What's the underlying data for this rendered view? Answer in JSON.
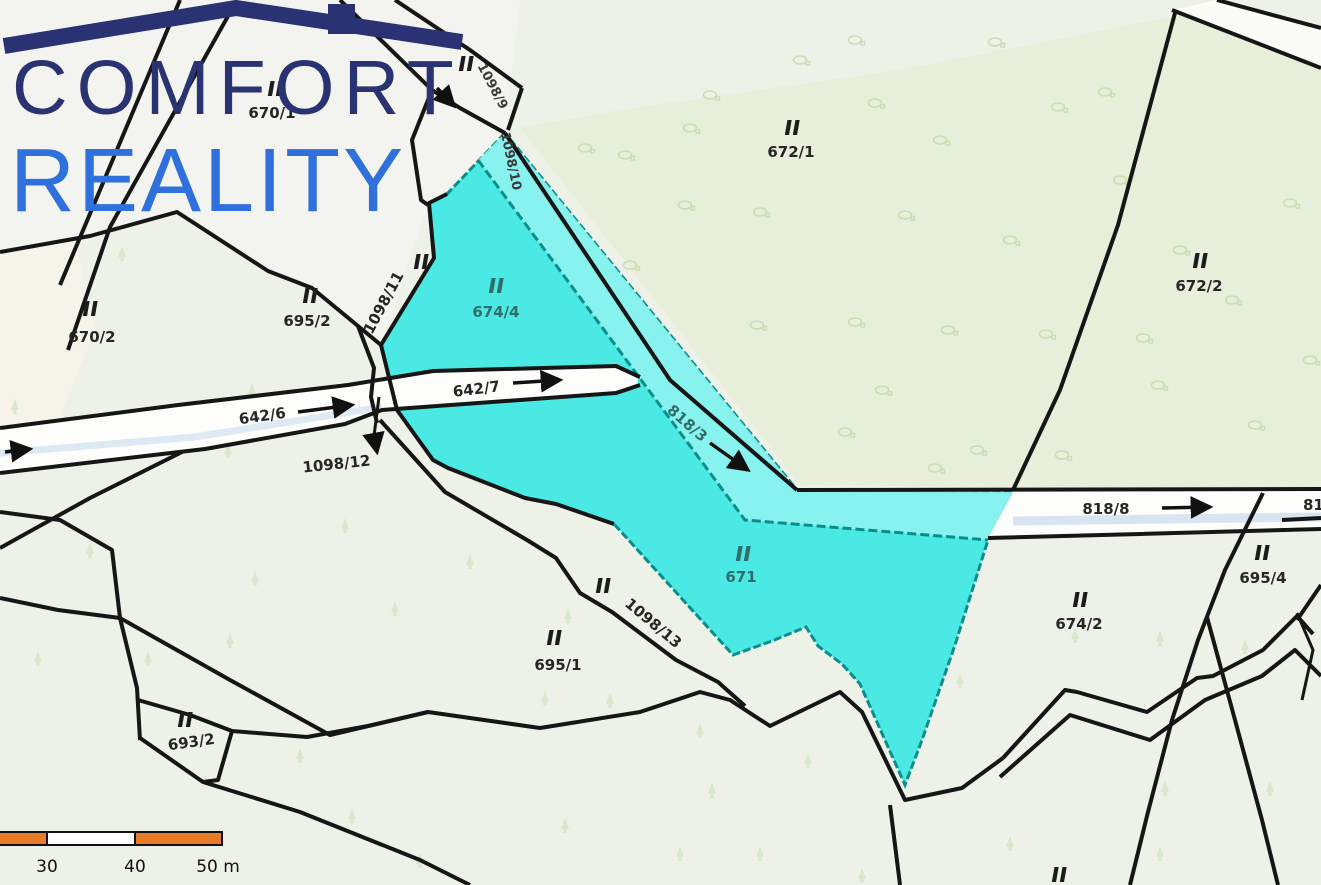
{
  "watermark": {
    "title": "COMFORT",
    "subtitle": "REALITY"
  },
  "scale_bar": {
    "tick_30": "30",
    "tick_40": "40",
    "tick_50": "50 m"
  },
  "map": {
    "land_use_symbol": "‖",
    "parcels": [
      {
        "label": "670/1"
      },
      {
        "label": "670/2"
      },
      {
        "label": "695/2"
      },
      {
        "label": "1098/11"
      },
      {
        "label": "674/4"
      },
      {
        "label": "672/1"
      },
      {
        "label": "672/2"
      },
      {
        "label": "642/6"
      },
      {
        "label": "642/7"
      },
      {
        "label": "1098/12"
      },
      {
        "label": "818/3"
      },
      {
        "label": "671"
      },
      {
        "label": "1098/13"
      },
      {
        "label": "695/1"
      },
      {
        "label": "693/2"
      },
      {
        "label": "674/2"
      },
      {
        "label": "695/4"
      },
      {
        "label": "818/8"
      },
      {
        "label": "818/8"
      },
      {
        "label": "1098/9"
      },
      {
        "label": "1098/10"
      }
    ],
    "colors": {
      "background": "#edf1e8",
      "forest_tint": "#e7efdb",
      "highlight": "#4ae9e4",
      "highlight_stream": "#8ff3ee",
      "highlight_border": "#0a8e8b",
      "boundary": "#161616",
      "scale_orange": "#e87b28",
      "brand_navy": "#2a3372",
      "brand_blue": "#2f70dc"
    }
  }
}
